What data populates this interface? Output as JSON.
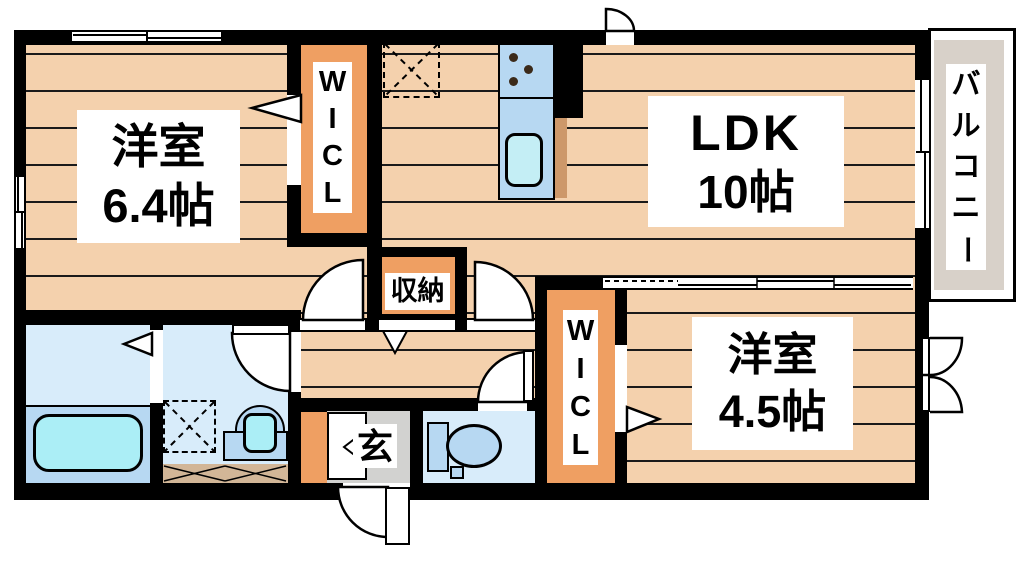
{
  "rooms": {
    "bedroom_top_left": {
      "name": "洋室",
      "size": "6.4帖"
    },
    "ldk": {
      "name": "LDK",
      "size": "10帖"
    },
    "bedroom_bottom_right": {
      "name": "洋室",
      "size": "4.5帖"
    },
    "storage": {
      "label": "収納"
    },
    "entrance": {
      "label": "玄"
    },
    "wicl_top": {
      "letters": [
        "W",
        "I",
        "C",
        "L"
      ]
    },
    "wicl_bottom": {
      "letters": [
        "W",
        "I",
        "C",
        "L"
      ]
    },
    "balcony": {
      "label": "バルコニー",
      "chars": [
        "バ",
        "ル",
        "コ",
        "ニ",
        "ー"
      ]
    }
  },
  "colors": {
    "floor_peach": "#f4d1ad",
    "closet_orange": "#ef9f62",
    "wet_room_blue": "#d8ecfa",
    "fixture_blue": "#b7d8f2",
    "tub_cyan": "#abeef6",
    "entrance_gray": "#d2d2d0",
    "balcony_gray": "#d8d1c9",
    "hatch_tan": "#d2b697",
    "counter_brown": "#cd986a",
    "wall_black": "#000000"
  }
}
